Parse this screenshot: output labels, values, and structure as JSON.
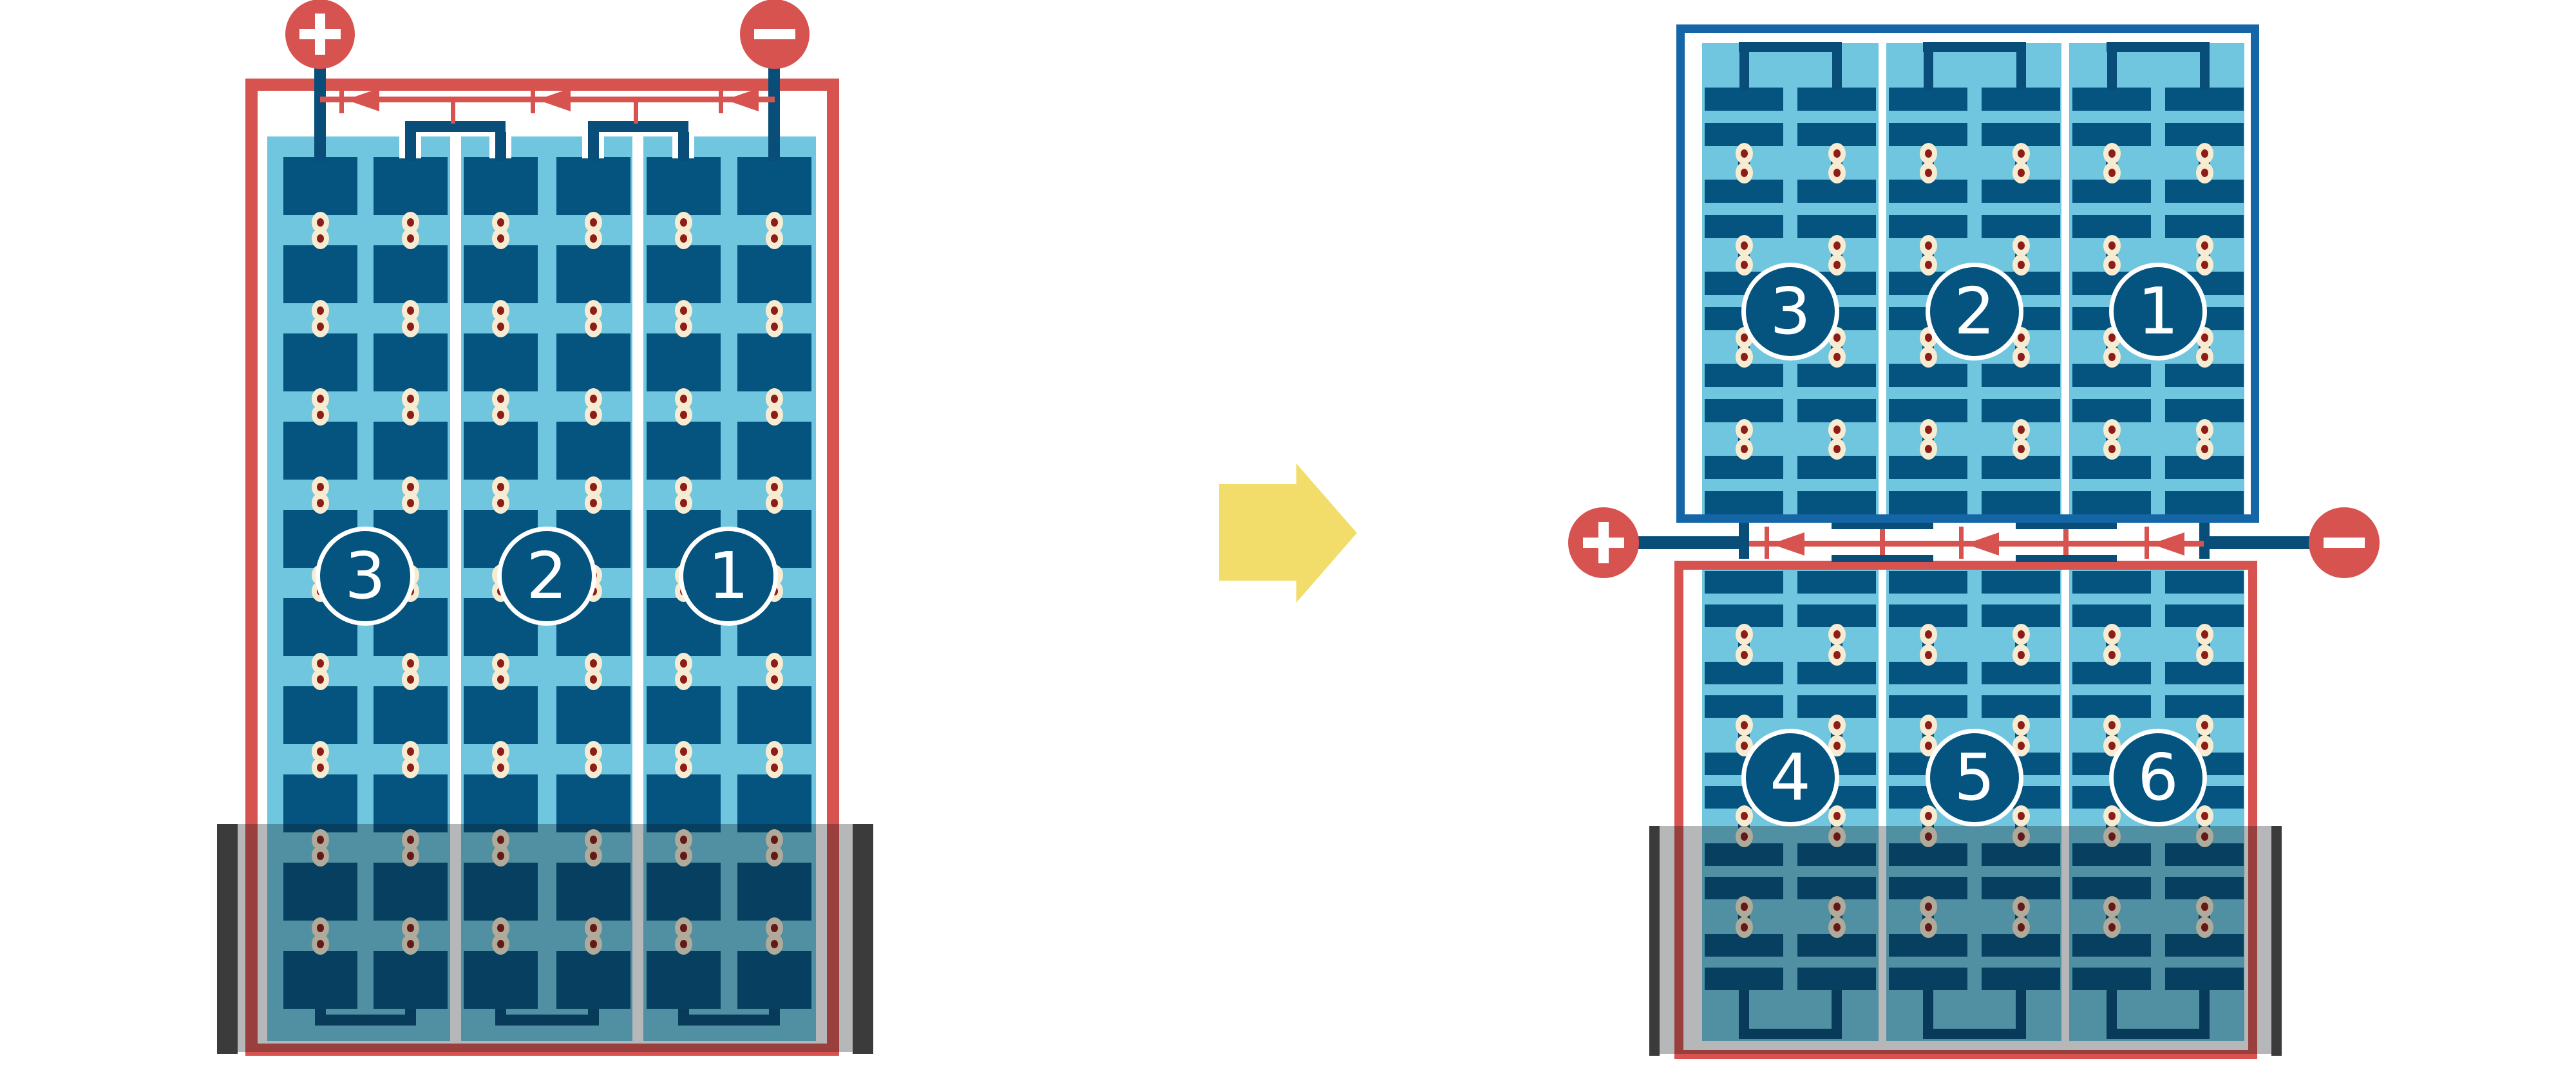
{
  "diagram": {
    "type": "solar-module-string-wiring-comparison",
    "arrow_direction": "right"
  },
  "colors": {
    "module_red": "#d75350",
    "frame_blue": "#1566a7",
    "cell_navy": "#05537f",
    "connector_navy": "#084e78",
    "panel_light_blue": "#70c6df",
    "dot_cream": "#f7ecd2",
    "dot_maroon": "#8e1c17",
    "shade_bar_gray": "#3b3b3b",
    "arrow_yellow": "#f2dd6a",
    "background": "#ffffff"
  },
  "left_module": {
    "terminal_positive": "+",
    "terminal_negative": "−",
    "string_labels": [
      "3",
      "2",
      "1"
    ],
    "cell_rows": 10,
    "cell_columns": 6,
    "bypass_diode_count": 3,
    "shaded_bottom": true
  },
  "right_top_module": {
    "frame_color_name": "blue",
    "string_labels": [
      "3",
      "2",
      "1"
    ],
    "cell_rows": 10,
    "cell_columns": 6
  },
  "right_junction": {
    "terminal_positive": "+",
    "terminal_negative": "−",
    "bypass_diode_count": 3
  },
  "right_bottom_module": {
    "frame_color_name": "red",
    "string_labels": [
      "4",
      "5",
      "6"
    ],
    "cell_rows": 10,
    "cell_columns": 6,
    "shaded_bottom": true
  }
}
